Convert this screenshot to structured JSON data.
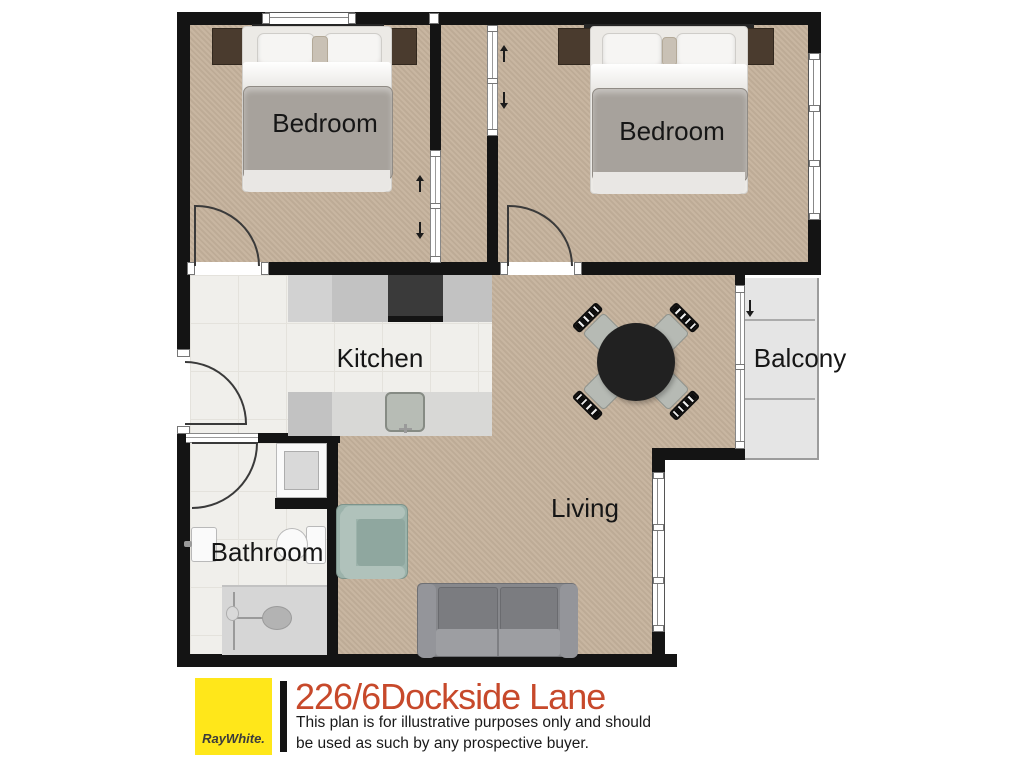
{
  "plan": {
    "labels": {
      "bedroom1": "Bedroom",
      "bedroom2": "Bedroom",
      "kitchen": "Kitchen",
      "bathroom": "Bathroom",
      "living": "Living",
      "balcony": "Balcony"
    },
    "palette": {
      "wall": "#141414",
      "floor_timber": "#c5b29c",
      "floor_tile": "#f0efeb",
      "balcony_floor": "#e5e5e5",
      "duvet": "#a7a29c",
      "nightstand": "#4a3b2e",
      "stove": "#3a3a3a",
      "armchair": "#9cb3ab",
      "sofa": "#87888c",
      "dining_table": "#212121"
    }
  },
  "footer": {
    "logo_text": "RayWhite.",
    "logo_bg": "#ffe71a",
    "title": "226/6Dockside Lane",
    "title_color": "#c7492b",
    "disclaimer_1": "This plan is for illustrative purposes only and should",
    "disclaimer_2": "be used as such by any prospective buyer."
  }
}
